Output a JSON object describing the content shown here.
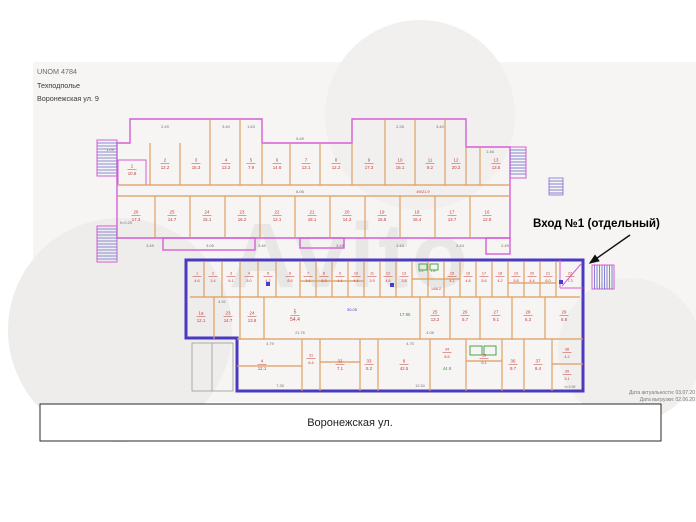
{
  "header": {
    "line1": "UNOM 4784",
    "line2": "Техподполье",
    "line3": "Воронежская ул. 9"
  },
  "entrance": {
    "label": "Вход №1 (отдельный)"
  },
  "street": {
    "label": "Воронежская ул."
  },
  "footnote": {
    "line1": "Дата актуальности: 03.07.20",
    "line2": "Дата выгрузки: 02.06.20"
  },
  "watermark": {
    "text": "Avito"
  },
  "colors": {
    "wall_pink": "#d45fd4",
    "wall_orange": "#dd9c5e",
    "highlight_blue": "#4b39c0",
    "hatch_blue": "#6868cc",
    "label_red": "#c43c3c",
    "label_green": "#3d9c3d",
    "label_blue": "#4040cc",
    "dim_gray": "#707070"
  },
  "plan": {
    "upper": {
      "outline": "M117,143 H130 V119 H262 V143 H352 V119 H466 V147 H510 V238 H117 Z",
      "tabs": [
        [
          163,
          238,
          92,
          12
        ],
        [
          300,
          238,
          44,
          10
        ],
        [
          486,
          238,
          24,
          16
        ]
      ],
      "inner_pink": [
        118,
        160,
        28,
        25
      ],
      "walls": [
        [
          150,
          143,
          150,
          185
        ],
        [
          180,
          143,
          180,
          185
        ],
        [
          210,
          119,
          210,
          185
        ],
        [
          240,
          119,
          240,
          185
        ],
        [
          262,
          143,
          262,
          185
        ],
        [
          290,
          143,
          290,
          185
        ],
        [
          320,
          143,
          320,
          185
        ],
        [
          352,
          143,
          352,
          185
        ],
        [
          385,
          119,
          385,
          185
        ],
        [
          415,
          119,
          415,
          185
        ],
        [
          445,
          119,
          445,
          185
        ],
        [
          466,
          147,
          466,
          185
        ],
        [
          480,
          147,
          480,
          185
        ],
        [
          117,
          185,
          510,
          185
        ],
        [
          117,
          196,
          510,
          196
        ],
        [
          155,
          196,
          155,
          238
        ],
        [
          190,
          196,
          190,
          238
        ],
        [
          225,
          196,
          225,
          238
        ],
        [
          260,
          196,
          260,
          238
        ],
        [
          295,
          196,
          295,
          238
        ],
        [
          330,
          196,
          330,
          238
        ],
        [
          365,
          196,
          365,
          238
        ],
        [
          400,
          196,
          400,
          238
        ],
        [
          435,
          196,
          435,
          238
        ],
        [
          470,
          196,
          470,
          238
        ]
      ]
    },
    "lower": {
      "outline": "M186,260 H583 V391 H237 V338 H186 Z",
      "walls": [
        [
          204,
          262,
          204,
          297
        ],
        [
          222,
          262,
          222,
          297
        ],
        [
          240,
          262,
          240,
          297
        ],
        [
          258,
          262,
          258,
          297
        ],
        [
          276,
          262,
          276,
          297
        ],
        [
          300,
          262,
          300,
          297
        ],
        [
          316,
          262,
          316,
          297
        ],
        [
          332,
          262,
          332,
          297
        ],
        [
          348,
          262,
          348,
          297
        ],
        [
          364,
          262,
          364,
          297
        ],
        [
          380,
          262,
          380,
          297
        ],
        [
          396,
          262,
          396,
          297
        ],
        [
          412,
          262,
          412,
          297
        ],
        [
          428,
          262,
          428,
          297
        ],
        [
          444,
          262,
          444,
          297
        ],
        [
          460,
          262,
          460,
          297
        ],
        [
          476,
          262,
          476,
          297
        ],
        [
          492,
          262,
          492,
          297
        ],
        [
          508,
          262,
          508,
          297
        ],
        [
          524,
          262,
          524,
          297
        ],
        [
          540,
          262,
          540,
          297
        ],
        [
          556,
          262,
          556,
          297
        ],
        [
          190,
          297,
          580,
          297
        ],
        [
          300,
          281,
          364,
          281
        ],
        [
          412,
          279,
          460,
          279
        ],
        [
          508,
          283,
          556,
          283
        ],
        [
          214,
          297,
          214,
          339
        ],
        [
          240,
          297,
          240,
          339
        ],
        [
          264,
          297,
          264,
          339
        ],
        [
          420,
          297,
          420,
          339
        ],
        [
          450,
          297,
          450,
          339
        ],
        [
          480,
          297,
          480,
          339
        ],
        [
          512,
          297,
          512,
          339
        ],
        [
          545,
          297,
          545,
          339
        ],
        [
          237,
          339,
          583,
          339
        ],
        [
          302,
          339,
          302,
          391
        ],
        [
          320,
          339,
          320,
          391
        ],
        [
          360,
          339,
          360,
          391
        ],
        [
          378,
          339,
          378,
          391
        ],
        [
          430,
          339,
          430,
          391
        ],
        [
          466,
          339,
          466,
          391
        ],
        [
          502,
          339,
          502,
          391
        ],
        [
          524,
          339,
          524,
          391
        ],
        [
          552,
          339,
          552,
          391
        ],
        [
          320,
          362,
          360,
          362
        ],
        [
          466,
          361,
          502,
          361
        ],
        [
          552,
          364,
          583,
          364
        ],
        [
          237,
          366,
          302,
          366
        ]
      ],
      "pink": [
        [
          560,
          260,
          560,
          288
        ],
        [
          560,
          288,
          583,
          288
        ],
        [
          562,
          286,
          581,
          264
        ]
      ],
      "porch_rect": [
        192,
        343,
        41,
        48
      ],
      "porch_line": [
        212,
        343,
        212,
        391
      ]
    },
    "stairs": [
      {
        "x": 97,
        "y": 140,
        "w": 20,
        "h": 36,
        "d": "h"
      },
      {
        "x": 97,
        "y": 226,
        "w": 20,
        "h": 36,
        "d": "h"
      },
      {
        "x": 510,
        "y": 147,
        "w": 16,
        "h": 31,
        "d": "h"
      },
      {
        "x": 549,
        "y": 178,
        "w": 14,
        "h": 17,
        "d": "h",
        "light": 1
      },
      {
        "x": 592,
        "y": 265,
        "w": 22,
        "h": 24,
        "d": "v"
      }
    ],
    "fixtures": [
      [
        470,
        346,
        12,
        9
      ],
      [
        484,
        346,
        12,
        9
      ],
      [
        419,
        264,
        8,
        6
      ],
      [
        430,
        264,
        8,
        6
      ]
    ],
    "markers": [
      [
        266,
        282
      ],
      [
        559,
        280
      ],
      [
        390,
        283
      ]
    ],
    "labels": [
      {
        "t": "1/10.8",
        "x": 132,
        "y": 169,
        "f": 1
      },
      {
        "t": "2/12.2",
        "x": 165,
        "y": 163,
        "f": 1
      },
      {
        "t": "3/15.3",
        "x": 196,
        "y": 163,
        "f": 1
      },
      {
        "t": "4/13.2",
        "x": 226,
        "y": 163,
        "f": 1
      },
      {
        "t": "5/7.9",
        "x": 251,
        "y": 163,
        "f": 1
      },
      {
        "t": "6/14.6",
        "x": 277,
        "y": 163,
        "f": 1
      },
      {
        "t": "7/13.1",
        "x": 306,
        "y": 163,
        "f": 1
      },
      {
        "t": "8/12.2",
        "x": 336,
        "y": 163,
        "f": 1
      },
      {
        "t": "9/17.3",
        "x": 369,
        "y": 163,
        "f": 1
      },
      {
        "t": "10/15.1",
        "x": 400,
        "y": 163,
        "f": 1
      },
      {
        "t": "11/8.2",
        "x": 430,
        "y": 163,
        "f": 1
      },
      {
        "t": "12/20.2",
        "x": 456,
        "y": 163,
        "f": 1
      },
      {
        "t": "13/13.5",
        "x": 496,
        "y": 163,
        "f": 1
      },
      {
        "t": "49/21.9",
        "x": 423,
        "y": 193,
        "fs": 4
      },
      {
        "t": "6.06",
        "x": 300,
        "y": 193,
        "c": "gray",
        "fs": 4
      },
      {
        "t": "26/17.3",
        "x": 136,
        "y": 215,
        "f": 1
      },
      {
        "t": "25/14.7",
        "x": 172,
        "y": 215,
        "f": 1
      },
      {
        "t": "24/15.1",
        "x": 207,
        "y": 215,
        "f": 1
      },
      {
        "t": "23/16.2",
        "x": 242,
        "y": 215,
        "f": 1
      },
      {
        "t": "22/12.1",
        "x": 277,
        "y": 215,
        "f": 1
      },
      {
        "t": "21/18.1",
        "x": 312,
        "y": 215,
        "f": 1
      },
      {
        "t": "20/14.3",
        "x": 347,
        "y": 215,
        "f": 1
      },
      {
        "t": "19/15.8",
        "x": 382,
        "y": 215,
        "f": 1
      },
      {
        "t": "18/16.4",
        "x": 417,
        "y": 215,
        "f": 1
      },
      {
        "t": "17/13.7",
        "x": 452,
        "y": 215,
        "f": 1
      },
      {
        "t": "16/12.9",
        "x": 487,
        "y": 215,
        "f": 1
      },
      {
        "t": "2.49",
        "x": 165,
        "y": 128,
        "c": "gray",
        "fs": 4
      },
      {
        "t": "3.40",
        "x": 226,
        "y": 128,
        "c": "gray",
        "fs": 4
      },
      {
        "t": "1.63",
        "x": 251,
        "y": 128,
        "c": "gray",
        "fs": 4
      },
      {
        "t": "2.28",
        "x": 400,
        "y": 128,
        "c": "gray",
        "fs": 4
      },
      {
        "t": "3.40",
        "x": 440,
        "y": 128,
        "c": "gray",
        "fs": 4
      },
      {
        "t": "5.49",
        "x": 300,
        "y": 140,
        "c": "gray",
        "fs": 4
      },
      {
        "t": "1.46",
        "x": 490,
        "y": 153,
        "c": "gray",
        "fs": 4
      },
      {
        "t": "1.09",
        "x": 110,
        "y": 151,
        "c": "gray",
        "fs": 4
      },
      {
        "t": "h=0.25",
        "x": 126,
        "y": 224,
        "c": "gray",
        "fs": 3.8
      },
      {
        "t": "3.49",
        "x": 150,
        "y": 247,
        "c": "gray",
        "fs": 4
      },
      {
        "t": "3.05",
        "x": 210,
        "y": 247,
        "c": "gray",
        "fs": 4
      },
      {
        "t": "3.40",
        "x": 262,
        "y": 247,
        "c": "gray",
        "fs": 4
      },
      {
        "t": "3.49",
        "x": 340,
        "y": 247,
        "c": "gray",
        "fs": 4
      },
      {
        "t": "3.43",
        "x": 400,
        "y": 247,
        "c": "gray",
        "fs": 4
      },
      {
        "t": "2.44",
        "x": 460,
        "y": 247,
        "c": "gray",
        "fs": 4
      },
      {
        "t": "2.49",
        "x": 505,
        "y": 247,
        "c": "gray",
        "fs": 4
      },
      {
        "t": "1/4.6",
        "x": 197,
        "y": 276,
        "f": 1,
        "fs": 3.8
      },
      {
        "t": "2/3.4",
        "x": 213,
        "y": 276,
        "f": 1,
        "fs": 3.8
      },
      {
        "t": "3/6.1",
        "x": 231,
        "y": 276,
        "f": 1,
        "fs": 3.8
      },
      {
        "t": "4/5.0",
        "x": 249,
        "y": 276,
        "f": 1,
        "fs": 3.8
      },
      {
        "t": "5/4.2",
        "x": 268,
        "y": 276,
        "f": 1,
        "fs": 3.8
      },
      {
        "t": "6/8.6",
        "x": 290,
        "y": 276,
        "f": 1,
        "fs": 3.8
      },
      {
        "t": "7/3.1",
        "x": 308,
        "y": 276,
        "f": 1,
        "fs": 3.8
      },
      {
        "t": "8/5.3",
        "x": 324,
        "y": 276,
        "f": 1,
        "fs": 3.8
      },
      {
        "t": "9/4.1",
        "x": 340,
        "y": 276,
        "f": 1,
        "fs": 3.8
      },
      {
        "t": "10/4.4",
        "x": 356,
        "y": 276,
        "f": 1,
        "fs": 3.8
      },
      {
        "t": "11/3.9",
        "x": 372,
        "y": 276,
        "f": 1,
        "fs": 3.8
      },
      {
        "t": "12/4.6",
        "x": 388,
        "y": 276,
        "f": 1,
        "fs": 3.8
      },
      {
        "t": "13/3.8",
        "x": 404,
        "y": 276,
        "f": 1,
        "fs": 3.8
      },
      {
        "t": "2.2",
        "x": 421,
        "y": 272,
        "c": "green",
        "fs": 3.5
      },
      {
        "t": "1.8",
        "x": 433,
        "y": 272,
        "c": "green",
        "fs": 3.5
      },
      {
        "t": "14/6.2",
        "x": 436,
        "y": 290,
        "fs": 3.6
      },
      {
        "t": "15/4.1",
        "x": 452,
        "y": 276,
        "f": 1,
        "fs": 3.8
      },
      {
        "t": "16/4.8",
        "x": 468,
        "y": 276,
        "f": 1,
        "fs": 3.8
      },
      {
        "t": "17/5.6",
        "x": 484,
        "y": 276,
        "f": 1,
        "fs": 3.8
      },
      {
        "t": "18/4.2",
        "x": 500,
        "y": 276,
        "f": 1,
        "fs": 3.8
      },
      {
        "t": "19/5.8",
        "x": 516,
        "y": 276,
        "f": 1,
        "fs": 3.8
      },
      {
        "t": "20/4.4",
        "x": 532,
        "y": 276,
        "f": 1,
        "fs": 3.8
      },
      {
        "t": "21/6.0",
        "x": 548,
        "y": 276,
        "f": 1,
        "fs": 3.8
      },
      {
        "t": "22/7.3",
        "x": 570,
        "y": 276,
        "f": 1,
        "fs": 3.8
      },
      {
        "t": "1а/12.1",
        "x": 201,
        "y": 316,
        "f": 1
      },
      {
        "t": "23/14.7",
        "x": 228,
        "y": 316,
        "f": 1
      },
      {
        "t": "24/13.8",
        "x": 252,
        "y": 316,
        "f": 1
      },
      {
        "t": "5/54.4",
        "x": 295,
        "y": 315,
        "f": 1,
        "fs": 5
      },
      {
        "t": "30.05",
        "x": 352,
        "y": 311,
        "c": "blue",
        "fs": 4
      },
      {
        "t": "17.95",
        "x": 405,
        "y": 316,
        "c": "green",
        "fs": 4.4
      },
      {
        "t": "25/13.2",
        "x": 435,
        "y": 315,
        "f": 1
      },
      {
        "t": "26/5.7",
        "x": 465,
        "y": 315,
        "f": 1
      },
      {
        "t": "27/9.1",
        "x": 496,
        "y": 315,
        "f": 1
      },
      {
        "t": "28/6.3",
        "x": 528,
        "y": 315,
        "f": 1
      },
      {
        "t": "29/8.8",
        "x": 564,
        "y": 315,
        "f": 1
      },
      {
        "t": "4.92",
        "x": 222,
        "y": 303,
        "c": "gray",
        "fs": 3.8
      },
      {
        "t": "21.76",
        "x": 300,
        "y": 334,
        "c": "gray",
        "fs": 3.8
      },
      {
        "t": "4.08",
        "x": 430,
        "y": 334,
        "c": "gray",
        "fs": 3.8
      },
      {
        "t": "4/12.1",
        "x": 262,
        "y": 364,
        "f": 1
      },
      {
        "t": "31/6.4",
        "x": 311,
        "y": 358,
        "f": 1,
        "fs": 3.8
      },
      {
        "t": "32/7.1",
        "x": 340,
        "y": 364,
        "f": 1
      },
      {
        "t": "33/5.2",
        "x": 369,
        "y": 364,
        "f": 1
      },
      {
        "t": "8/42.5",
        "x": 404,
        "y": 364,
        "f": 1
      },
      {
        "t": "34/8.6",
        "x": 447,
        "y": 352,
        "f": 1,
        "fs": 3.8
      },
      {
        "t": "44.9",
        "x": 447,
        "y": 370,
        "c": "green",
        "fs": 4.4
      },
      {
        "t": "35/6.1",
        "x": 484,
        "y": 358,
        "f": 1,
        "fs": 3.8
      },
      {
        "t": "36/9.7",
        "x": 513,
        "y": 364,
        "f": 1
      },
      {
        "t": "37/8.4",
        "x": 538,
        "y": 364,
        "f": 1
      },
      {
        "t": "38/4.2",
        "x": 567,
        "y": 352,
        "f": 1,
        "fs": 3.8
      },
      {
        "t": "39/3.1",
        "x": 567,
        "y": 374,
        "f": 1,
        "fs": 3.8
      },
      {
        "t": "h=2.95",
        "x": 570,
        "y": 388,
        "c": "gray",
        "fs": 3.5
      },
      {
        "t": "4.79",
        "x": 270,
        "y": 345,
        "c": "gray",
        "fs": 3.8
      },
      {
        "t": "4.75",
        "x": 410,
        "y": 345,
        "c": "gray",
        "fs": 3.8
      },
      {
        "t": "7.35",
        "x": 280,
        "y": 387,
        "c": "gray",
        "fs": 3.8
      },
      {
        "t": "12.34",
        "x": 420,
        "y": 387,
        "c": "gray",
        "fs": 3.8
      }
    ]
  }
}
